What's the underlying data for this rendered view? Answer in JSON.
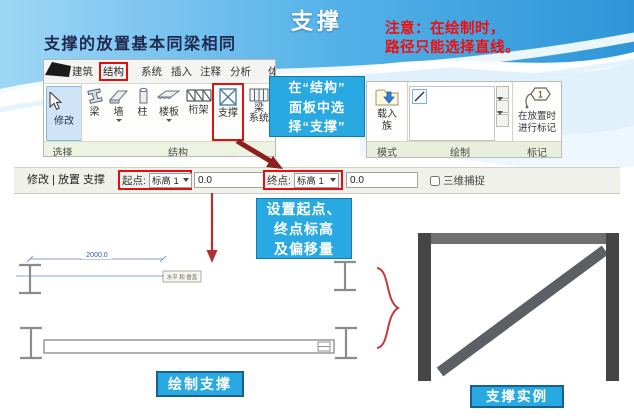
{
  "slide": {
    "title": "支撑",
    "note_line1": "注意：在绘制时，",
    "note_line2": "路径只能选择直线。",
    "subtitle": "支撑的放置基本同梁相同"
  },
  "ribbon": {
    "tabs": [
      "建筑",
      "结构",
      "系统",
      "插入",
      "注释",
      "分析"
    ],
    "partial_tab": "体",
    "highlighted_tab": "结构",
    "modify_label": "修改",
    "select_panel_label": "选择",
    "structure_panel_label": "结构",
    "tools": [
      {
        "label": "梁"
      },
      {
        "label": "墙"
      },
      {
        "label": "柱"
      },
      {
        "label": "楼板"
      },
      {
        "label": "桁架"
      },
      {
        "label": "支撑"
      },
      {
        "label": "梁",
        "label2": "系统"
      }
    ],
    "highlighted_tool": "支撑",
    "load_family_line1": "载入",
    "load_family_line2": "族",
    "mode_panel_label": "模式",
    "draw_panel_label": "绘制",
    "tag_line1": "在放置时",
    "tag_line2": "进行标记",
    "tag_panel_label": "标记"
  },
  "callout_structure": {
    "line1": "在“结构”",
    "line2": "面板中选",
    "line3": "择“支撑”"
  },
  "options_bar": {
    "mode_text": "修改 | 放置 支撑",
    "start_label": "起点:",
    "start_level": "标高 1",
    "start_offset": "0.0",
    "end_label": "终点:",
    "end_level": "标高 1",
    "end_offset": "0.0",
    "snap_label": "三维捕捉",
    "snap_checked": false
  },
  "callout_settings": {
    "line1": "设置起点、",
    "line2": "终点标高",
    "line3": "及偏移量"
  },
  "sketch": {
    "dimension": "2000.0",
    "tooltip": "水平 和 垂直"
  },
  "labels": {
    "draw_brace": "绘制支撑",
    "brace_example": "支撑实例"
  },
  "colors": {
    "callout_blue": "#29a9e1",
    "highlight_red": "#e01010",
    "note_red": "#f20d0d",
    "arrow_maroon": "#8e1f1f",
    "header_blue": "#4aa8e0",
    "frame_gray": "#5c6064"
  }
}
